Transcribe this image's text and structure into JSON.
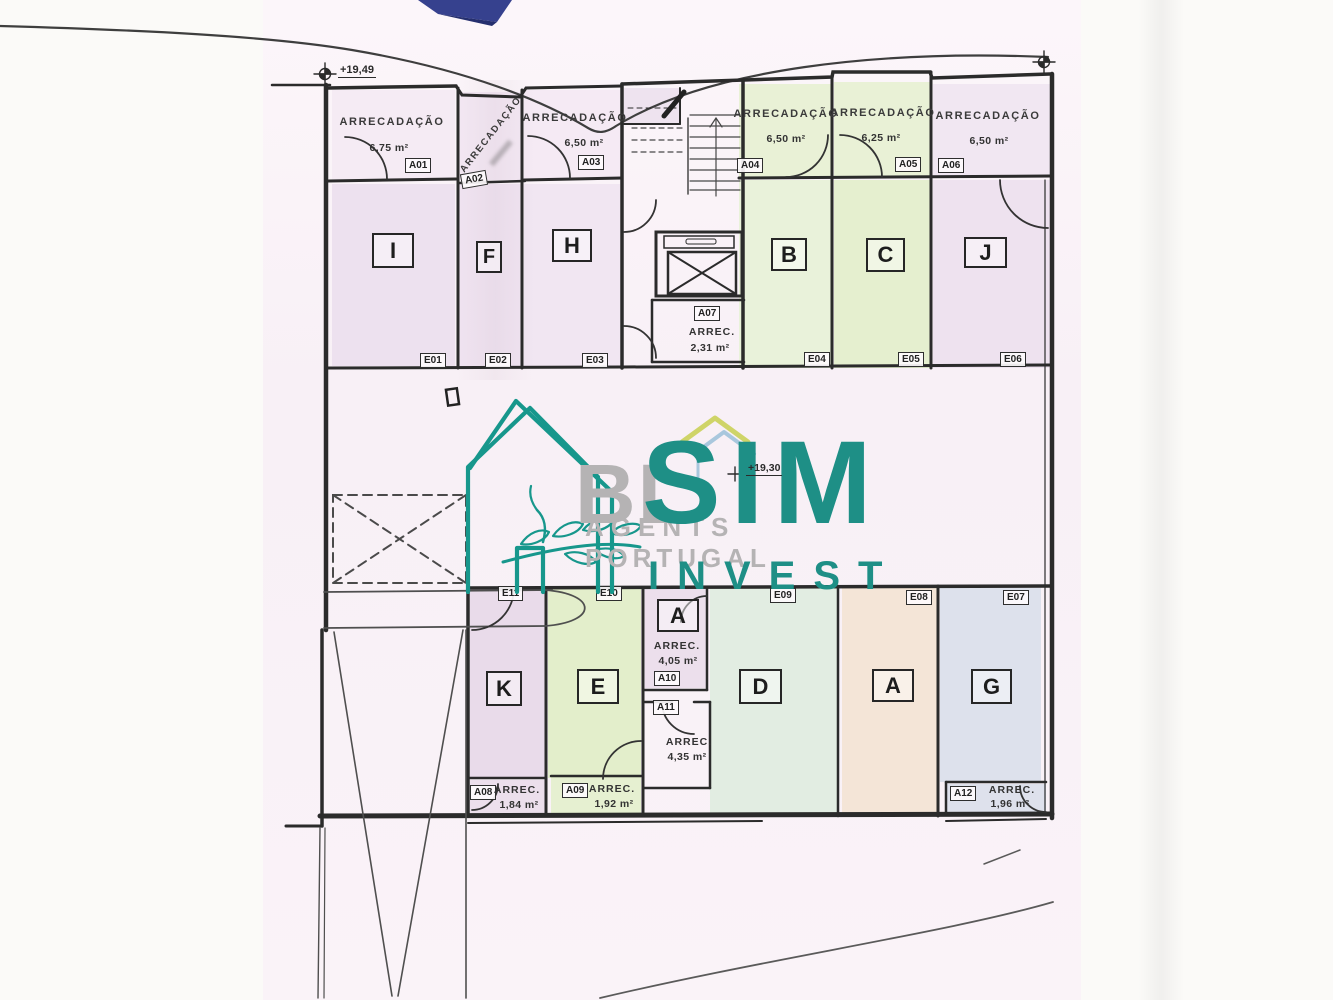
{
  "document": {
    "type": "scanned floor plan",
    "level_storage_label": "Arrecadações / Garagem"
  },
  "labels": {
    "storage": "ARRECADAÇÃO",
    "storage_short": "ARREC."
  },
  "elevations": {
    "top": "+19,49",
    "middle": "+19,30"
  },
  "storages": {
    "a01": {
      "id": "A01",
      "area": "6,75 m²"
    },
    "a02": {
      "id": "A02",
      "area": ""
    },
    "a03": {
      "id": "A03",
      "area": "6,50 m²"
    },
    "a04": {
      "id": "A04",
      "area": "6,50 m²"
    },
    "a05": {
      "id": "A05",
      "area": "6,25 m²"
    },
    "a06": {
      "id": "A06",
      "area": "6,50 m²"
    },
    "a07": {
      "id": "A07",
      "area": "2,31 m²"
    },
    "a08": {
      "id": "A08",
      "area": "1,84 m²"
    },
    "a09": {
      "id": "A09",
      "area": "1,92 m²"
    },
    "a10": {
      "id": "A10",
      "area": "4,05 m²"
    },
    "a11": {
      "id": "A11",
      "area": "4,35 m²"
    },
    "a12": {
      "id": "A12",
      "area": "1,96 m²"
    }
  },
  "units": {
    "i": {
      "letter": "I",
      "tag": "E01"
    },
    "f": {
      "letter": "F",
      "tag": "E02"
    },
    "h": {
      "letter": "H",
      "tag": "E03"
    },
    "b": {
      "letter": "B",
      "tag": "E04"
    },
    "c": {
      "letter": "C",
      "tag": "E05"
    },
    "j": {
      "letter": "J",
      "tag": "E06"
    },
    "k": {
      "letter": "K",
      "tag": "E11"
    },
    "e": {
      "letter": "E",
      "tag": "E10"
    },
    "a_small": {
      "letter": "A"
    },
    "d": {
      "letter": "D",
      "tag": "E09"
    },
    "a": {
      "letter": "A",
      "tag": "E08"
    },
    "g": {
      "letter": "G",
      "tag": "E07"
    }
  },
  "watermark": {
    "bl": "BL",
    "agents": "AGENTS",
    "portugal": "PORTUGAL",
    "sim": "SIM",
    "invest": "INVEST",
    "teal": "#17978c",
    "gray": "#b5b3b4"
  },
  "colors": {
    "wall": "#2b2b2b",
    "tint_pink": "#ede1ef",
    "tint_green": "#e6f0d1",
    "tint_mint": "#e2ede2",
    "tint_peach": "#f4e5d7",
    "tint_blue": "#dde1ec",
    "corner_navy": "#36418e"
  }
}
